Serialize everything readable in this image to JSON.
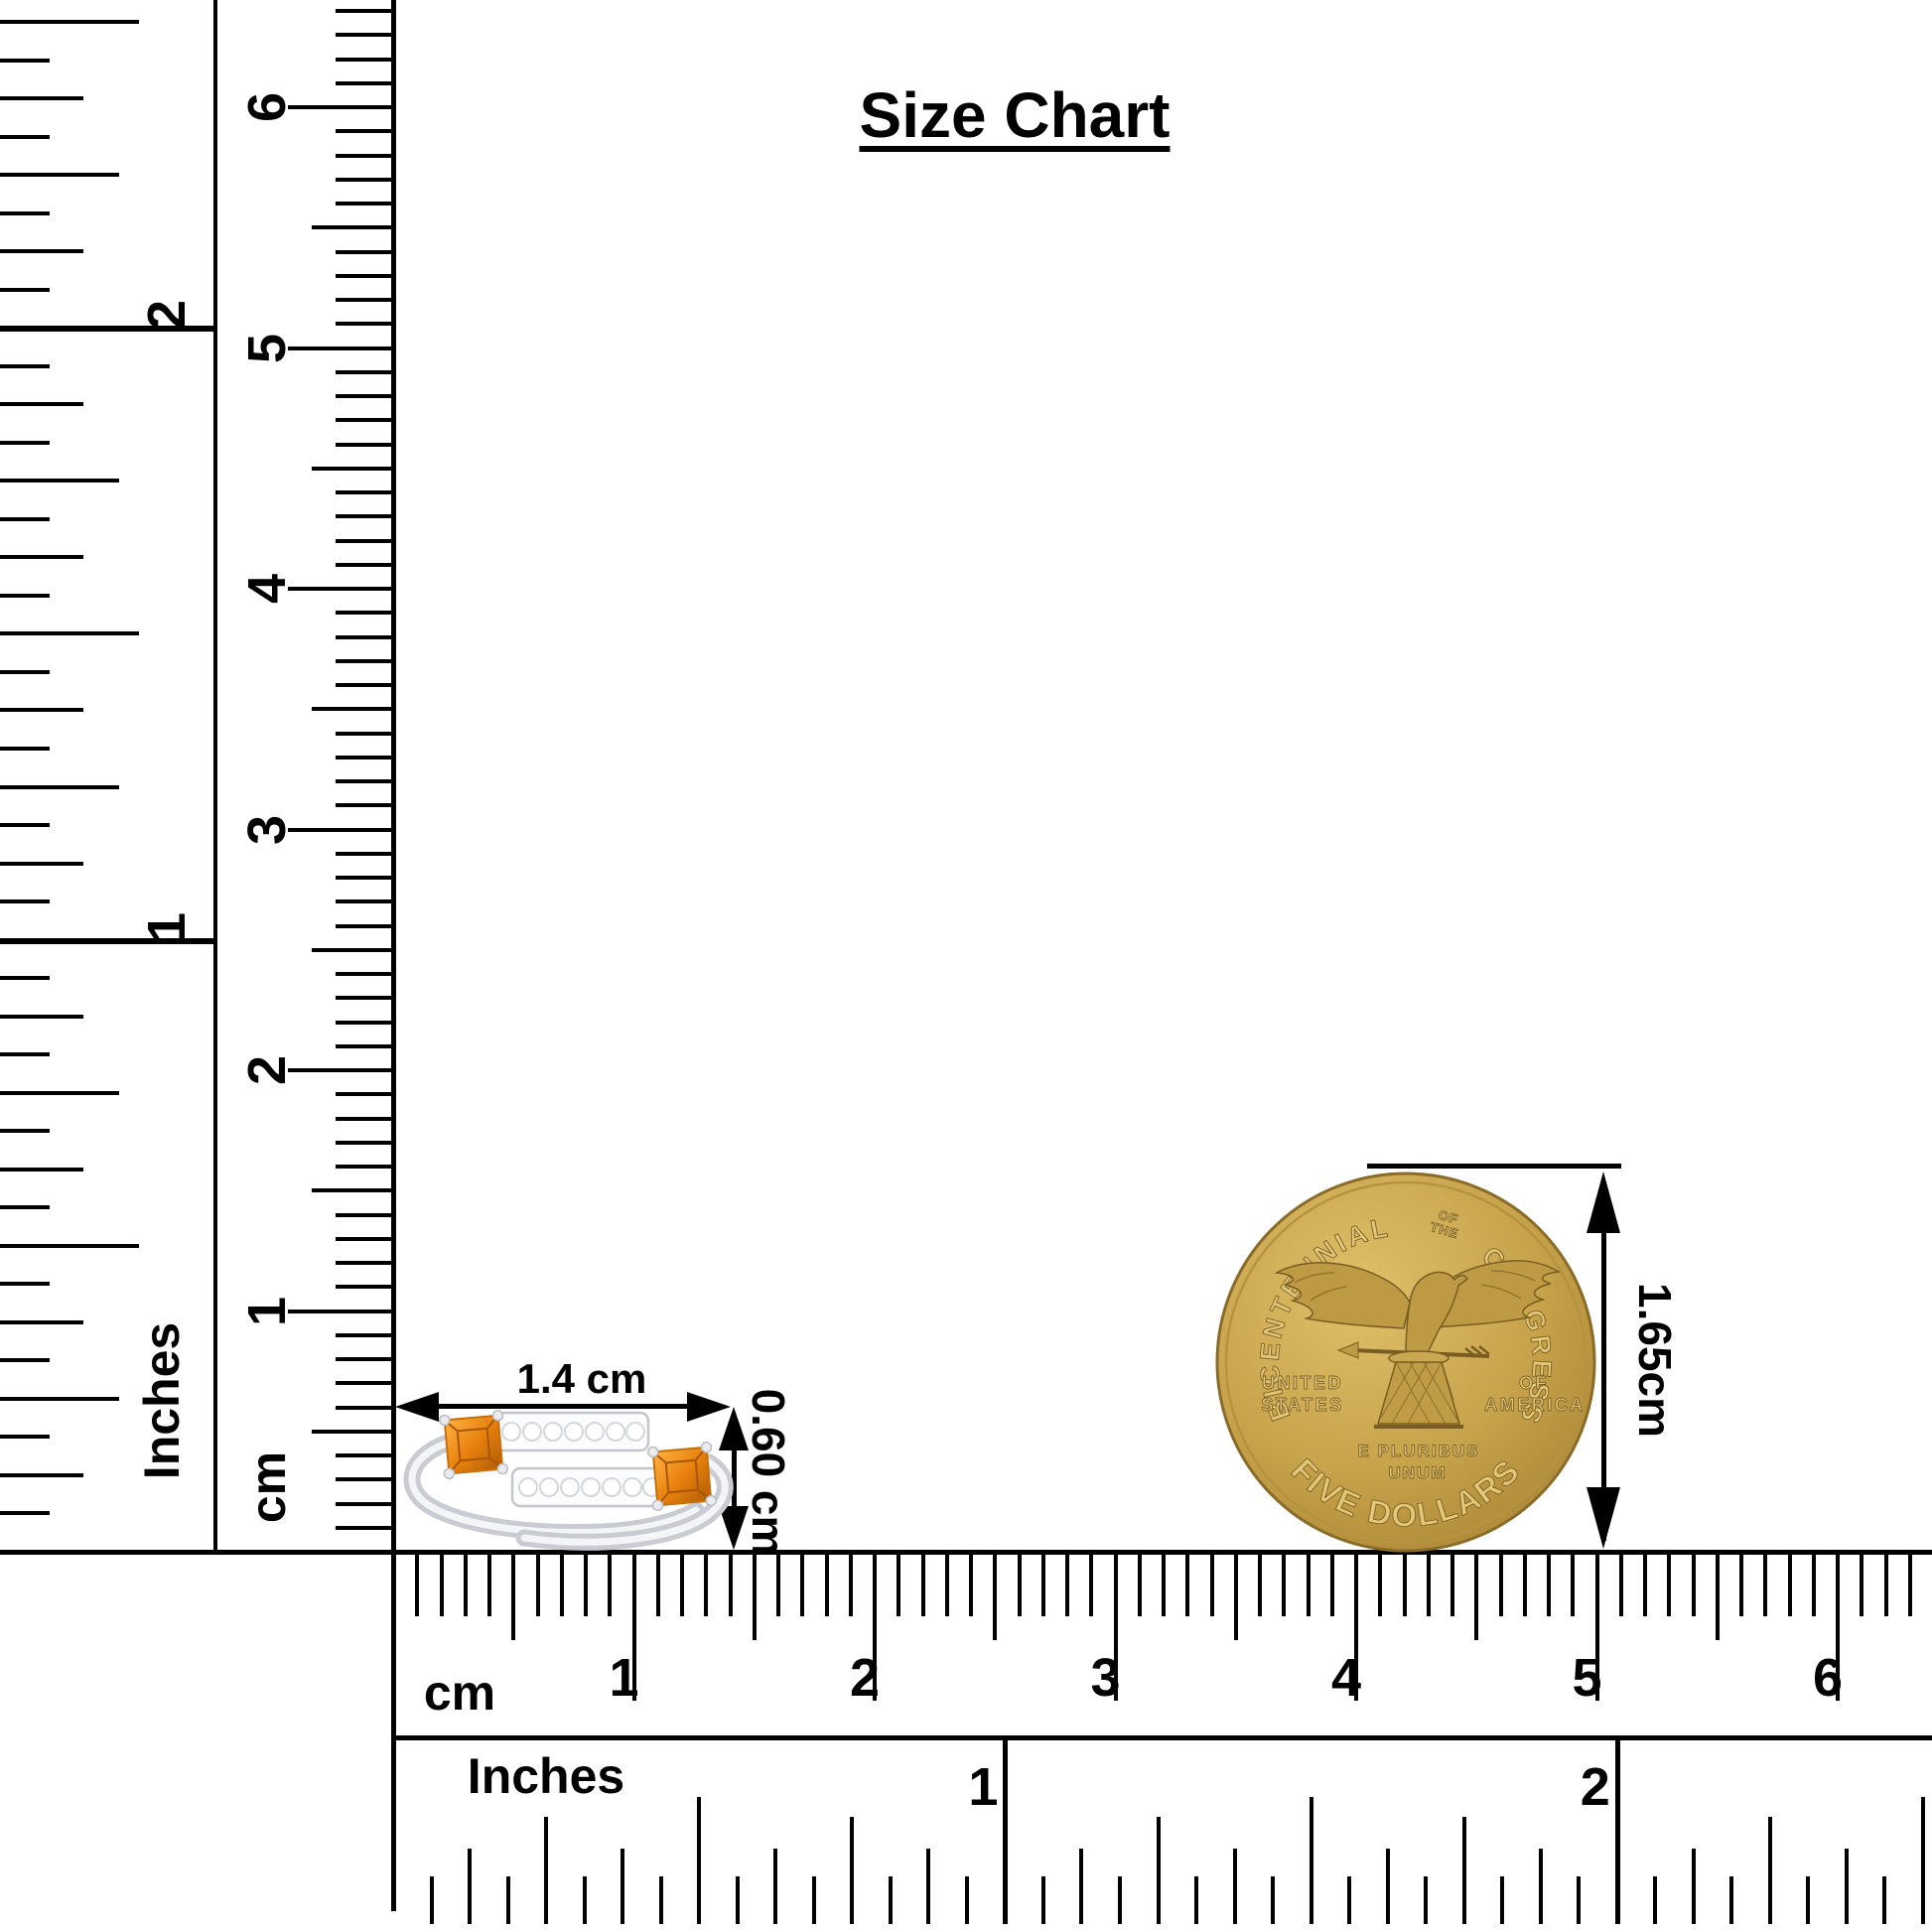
{
  "title": "Size Chart",
  "rulers": {
    "left_inches": {
      "label": "Inches",
      "numbers": [
        "1",
        "2"
      ]
    },
    "left_cm": {
      "label": "cm",
      "numbers": [
        "1",
        "2",
        "3",
        "4",
        "5",
        "6"
      ]
    },
    "bottom_cm": {
      "label": "cm",
      "numbers": [
        "1",
        "2",
        "3",
        "4",
        "5",
        "6"
      ]
    },
    "bottom_inches": {
      "label": "Inches",
      "numbers": [
        "1",
        "2"
      ]
    }
  },
  "ring": {
    "width_label": "1.4 cm",
    "height_label": "0.60 cm",
    "colors": {
      "stone": "#e8820c",
      "stone_dark": "#a85607",
      "stone_light": "#ffb347",
      "metal": "#dcdee2",
      "metal_light": "#f6f7f9",
      "metal_shadow": "#b9bdc4",
      "diamond": "#ffffff"
    }
  },
  "coin": {
    "arc_top_left": "BICENTENNIAL",
    "arc_top_small_1": "OF",
    "arc_top_small_2": "THE",
    "arc_top_right": "CONGRESS",
    "left_text_1": "UNITED",
    "left_text_2": "STATES",
    "right_text_1": "OF",
    "right_text_2": "AMERICA",
    "motto_1": "E PLURIBUS",
    "motto_2": "UNUM",
    "arc_bottom": "FIVE DOLLARS",
    "height_label": "1.65cm",
    "colors": {
      "gold": "#c7a34b",
      "gold_light": "#e9d086",
      "gold_dark": "#8a6b28",
      "rim": "#d9bc66",
      "letter": "#e2c777"
    }
  },
  "annotation_color": "#000000"
}
